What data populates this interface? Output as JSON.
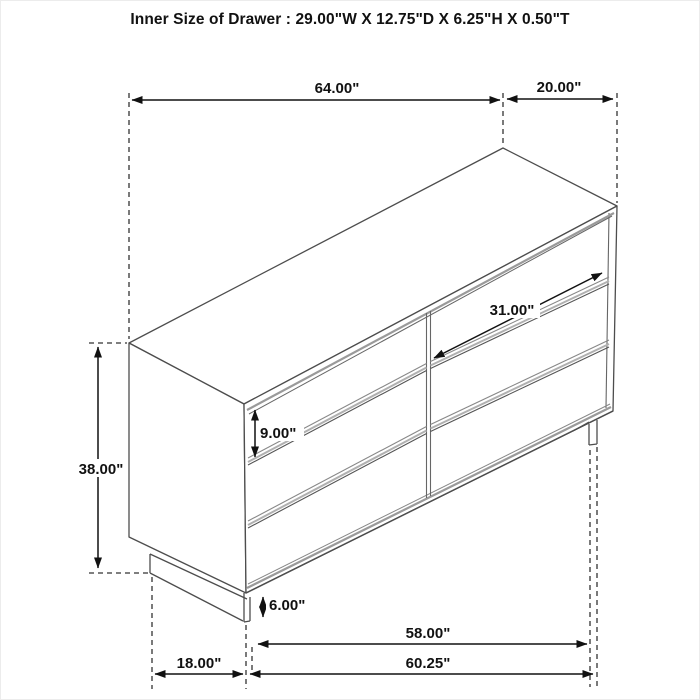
{
  "title": "Inner Size of Drawer : 29.00\"W X 12.75\"D X 6.25\"H X 0.50\"T",
  "diagram": {
    "type": "furniture-dimension-drawing",
    "object": "six-drawer dresser, isometric line drawing",
    "dimensions": {
      "top_width": "64.00\"",
      "top_depth": "20.00\"",
      "drawer_width": "31.00\"",
      "drawer_front_height": "9.00\"",
      "overall_height": "38.00\"",
      "base_height": "6.00\"",
      "leg_span_width": "58.00\"",
      "overall_bottom_width": "60.25\"",
      "bottom_depth": "18.00\""
    }
  }
}
